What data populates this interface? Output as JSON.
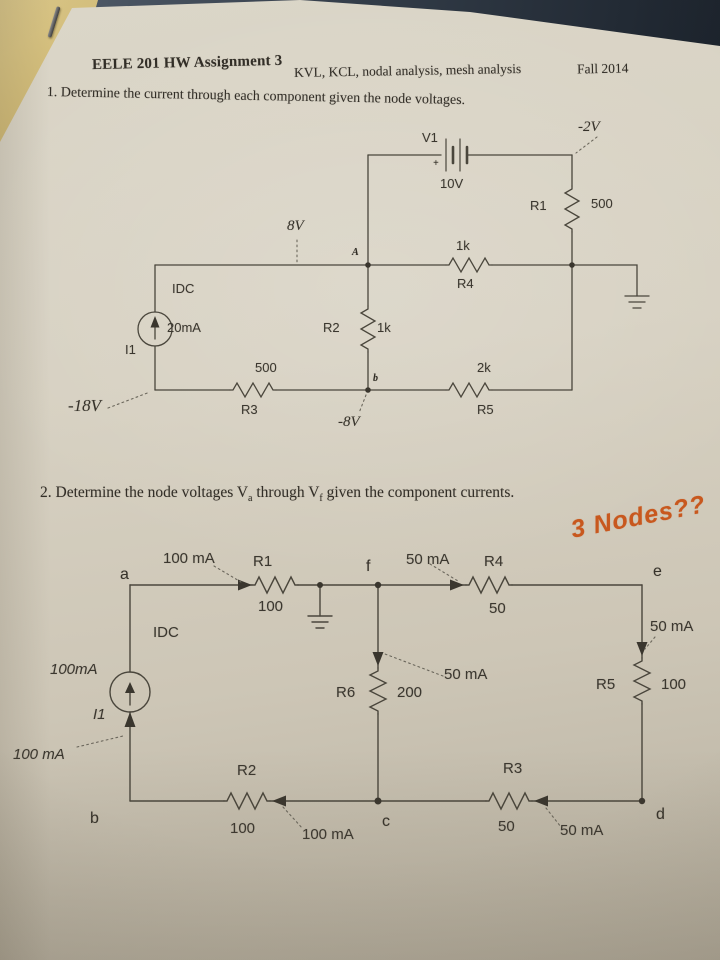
{
  "colors": {
    "paper": "#d6d0c2",
    "circuit_ink": "#46423a",
    "text_ink": "#322e27",
    "annotation_ink": "#c8581e"
  },
  "page": {
    "course_title": "EELE 201 HW Assignment 3",
    "topics": "KVL, KCL, nodal analysis, mesh analysis",
    "term": "Fall 2014",
    "question1": "1.  Determine the current through each component given the node voltages.",
    "question2_prefix": "2.  Determine the node voltages V",
    "question2_sub_a": "a",
    "question2_mid": " through V",
    "question2_sub_f": "f",
    "question2_suffix": " given the component currents.",
    "annotation": "3 Nodes??"
  },
  "circuit1": {
    "labels": {
      "v1": "V1",
      "v1_value": "10V",
      "battery_plus": "+",
      "node_top_right_voltage": "-2V",
      "r1": "R1",
      "r1_value": "500",
      "node_a_voltage": "8V",
      "node_a": "A",
      "r4": "R4",
      "r4_value": "1k",
      "idc": "IDC",
      "i1": "I1",
      "i1_value": "20mA",
      "r2": "R2",
      "r2_value": "1k",
      "r3": "R3",
      "r3_value": "500",
      "r5": "R5",
      "r5_value": "2k",
      "node_b": "b",
      "node_b_voltage": "-8V",
      "node_bottom_left_voltage": "-18V"
    }
  },
  "circuit2": {
    "labels": {
      "node_a": "a",
      "node_b": "b",
      "node_c": "c",
      "node_d": "d",
      "node_e": "e",
      "node_f": "f",
      "idc": "IDC",
      "i1": "I1",
      "i1_value": "100mA",
      "i1_current": "100 mA",
      "r1": "R1",
      "r1_value": "100",
      "r1_current": "100 mA",
      "r2": "R2",
      "r2_value": "100",
      "r2_current": "100 mA",
      "r3": "R3",
      "r3_value": "50",
      "r3_current": "50 mA",
      "r4": "R4",
      "r4_value": "50",
      "r4_current": "50 mA",
      "r5": "R5",
      "r5_value": "100",
      "r5_current": "50 mA",
      "r6": "R6",
      "r6_value": "200",
      "r6_current": "50 mA"
    }
  }
}
